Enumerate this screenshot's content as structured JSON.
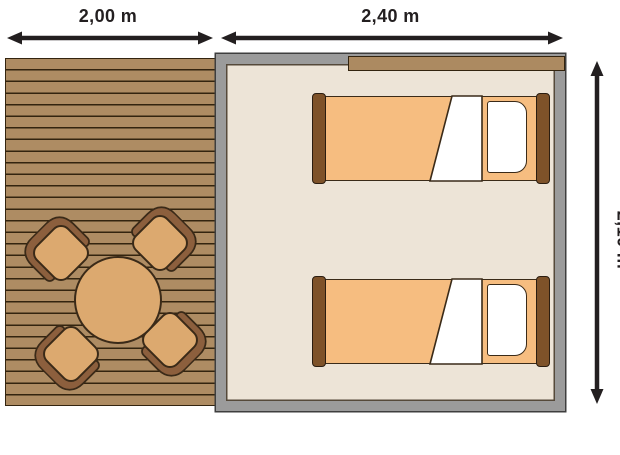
{
  "floorplan": {
    "type": "floor-plan",
    "areas": [
      {
        "name": "deck",
        "width_label": "2,00 m",
        "furniture": [
          "round-table",
          "chair",
          "chair",
          "chair",
          "chair"
        ]
      },
      {
        "name": "room",
        "width_label": "2,40 m",
        "furniture": [
          "single-bed",
          "single-bed"
        ]
      }
    ],
    "dimensions": {
      "deck_width": "2,00 m",
      "room_width": "2,40 m",
      "depth": "2,10 m",
      "depth_note": "rotated 90deg, clipped at right image edge"
    },
    "colors": {
      "deck_plank": "#AE8C63",
      "deck_line": "#33240F",
      "furniture_tan": "#DCA96F",
      "furniture_outline": "#3A2A18",
      "chair_back": "#8C5F3D",
      "room_floor": "#EDE4D7",
      "wall_gray": "#9B9B9B",
      "wall_outline": "#3E3E3E",
      "awning_brown": "#AC8A61",
      "mattress_orange": "#F6BD80",
      "bed_post_brown": "#7E5229",
      "bedding_white": "#FFFFFF",
      "dimension_ink": "#231F20"
    }
  }
}
